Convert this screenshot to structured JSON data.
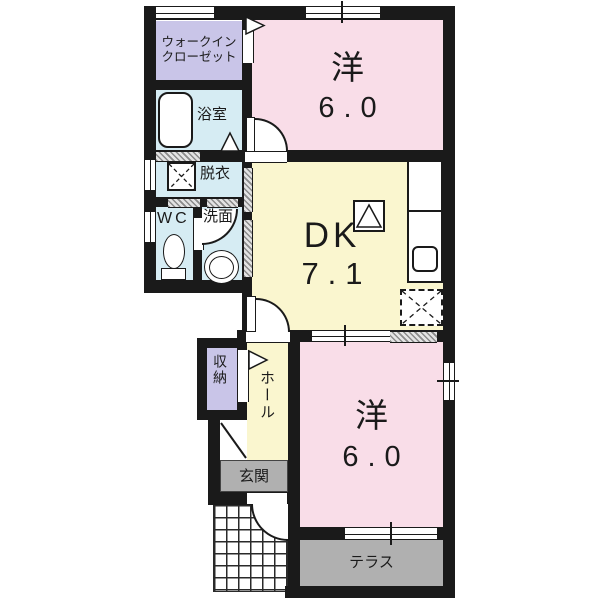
{
  "rooms": {
    "walk_in_closet": {
      "label_line1": "ウォークイン",
      "label_line2": "クローゼット"
    },
    "bathroom": {
      "label": "浴室"
    },
    "dressing_room": {
      "label": "脱衣"
    },
    "toilet": {
      "label": "WC"
    },
    "washroom": {
      "label": "洗面"
    },
    "bedroom_top": {
      "label": "洋",
      "size": "6.0"
    },
    "dining_kitchen": {
      "label": "DK",
      "size": "7.1"
    },
    "storage": {
      "label": "収納"
    },
    "hall": {
      "label": "ホール"
    },
    "entrance": {
      "label": "玄関"
    },
    "bedroom_bottom": {
      "label": "洋",
      "size": "6.0"
    },
    "terrace": {
      "label": "テラス"
    }
  },
  "colors": {
    "wall": "#1a1a1a",
    "bedroom_pink": "#f9dde8",
    "kitchen_yellow": "#faf6cf",
    "wet_area_blue": "#d6ecf3",
    "closet_lavender": "#c9c5e8",
    "outdoor_gray": "#b0b0b0",
    "background": "#ffffff"
  },
  "symbols": {
    "bathtub": "bathtub-symbol",
    "washer": "washing-machine-pan-symbol",
    "toilet": "toilet-symbol",
    "basin": "washbasin-symbol",
    "sink": "kitchen-sink-symbol",
    "stove": "stove-symbol",
    "fridge": "refrigerator-space-symbol",
    "tiles": "entrance-porch-tiles"
  }
}
